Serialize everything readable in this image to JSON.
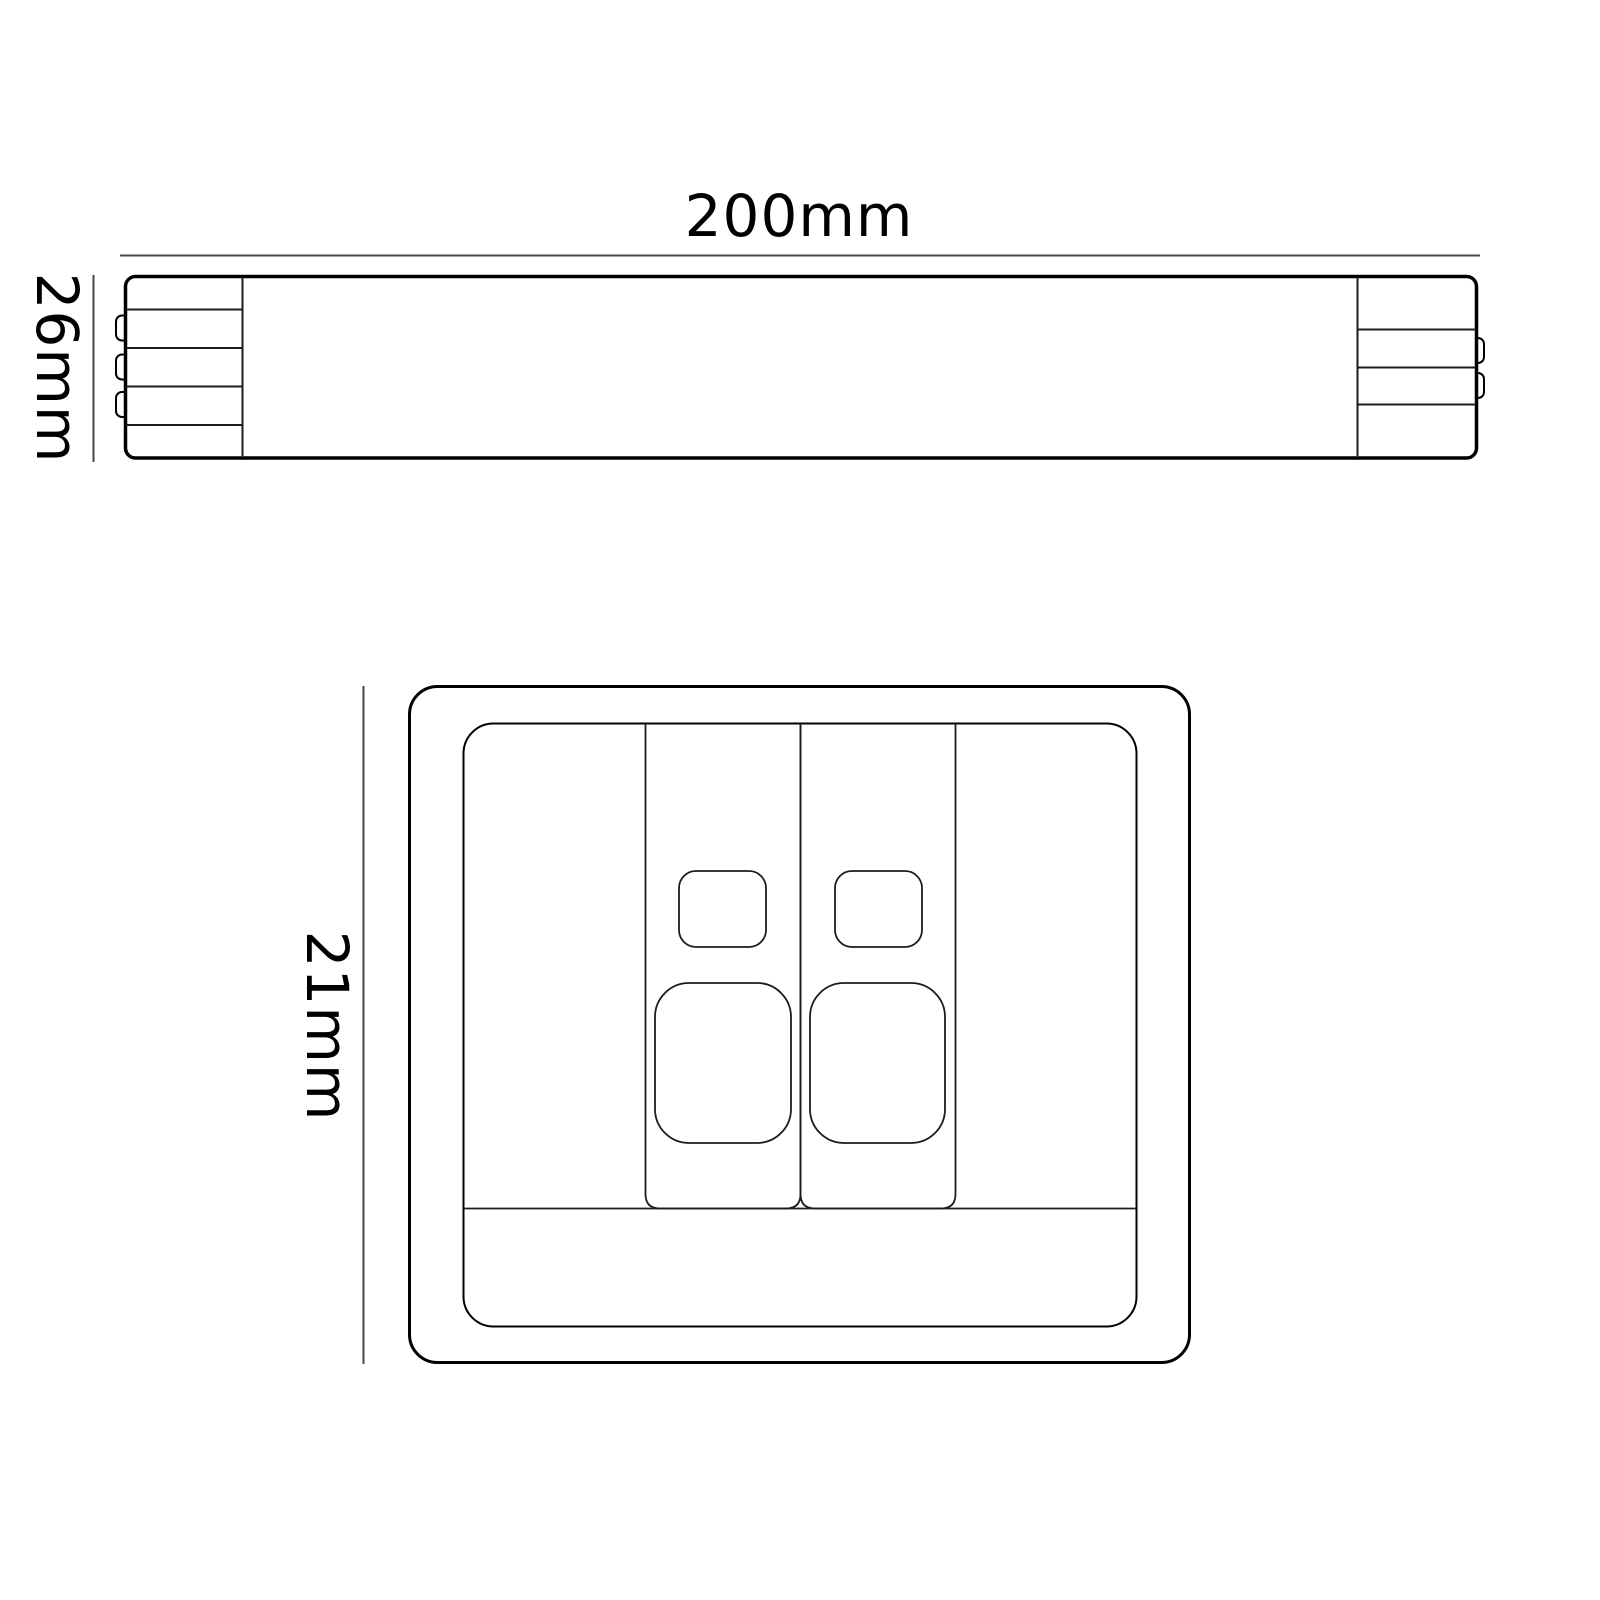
{
  "drawing": {
    "side_view": {
      "width_dimension": "200mm",
      "depth_dimension": "26mm"
    },
    "front_view": {
      "height_dimension": "21mm"
    },
    "colors": {
      "outline": "#000000",
      "detail_line": "#1c1c1c",
      "dimension_line": "#474747",
      "text": "#000000",
      "background": "#ffffff"
    }
  }
}
